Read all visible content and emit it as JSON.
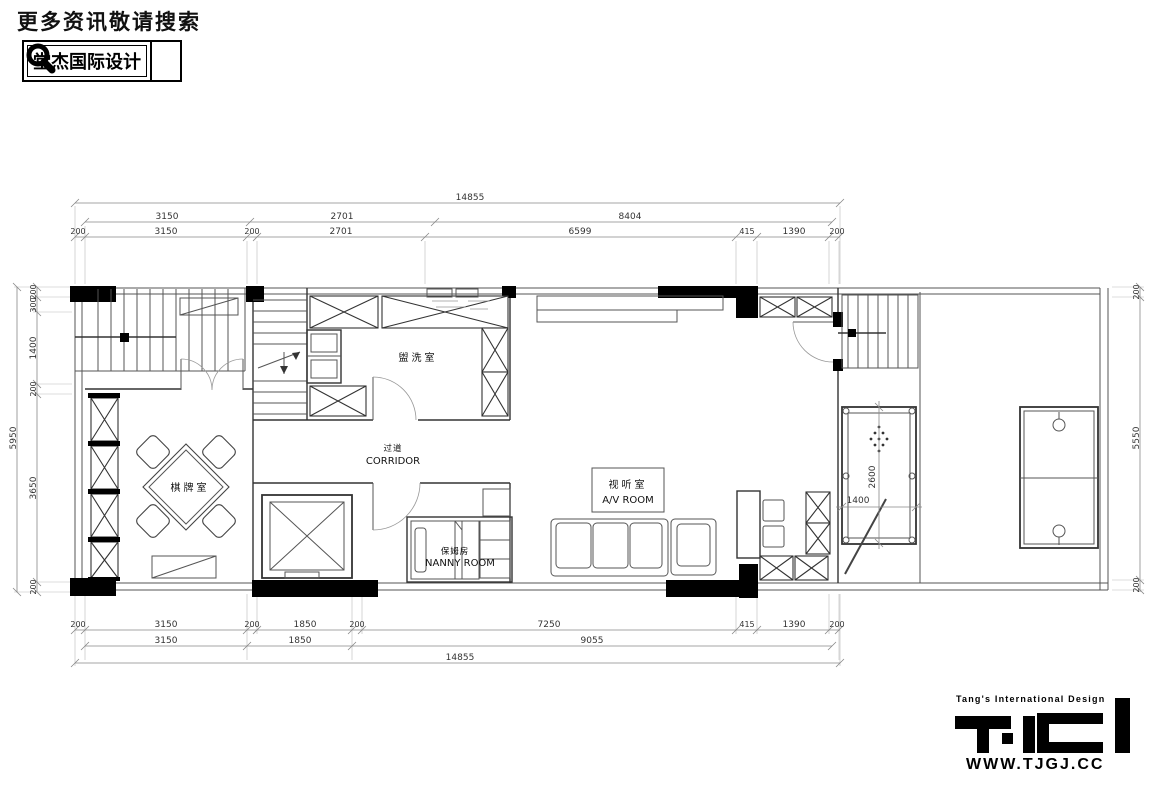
{
  "header": {
    "search_prompt": "更多资讯敬请搜索",
    "brand_name": "堂杰国际设计"
  },
  "branding": {
    "tagline": "Tang's International Design",
    "website": "WWW.TJGJ.CC"
  },
  "plan": {
    "labels": {
      "mahjong_room": "棋牌室",
      "laundry_room": "盥洗室",
      "corridor_cn": "过道",
      "corridor_en": "CORRIDOR",
      "nanny_cn": "保姆房",
      "nanny_en": "NANNY ROOM",
      "av_cn": "视听室",
      "av_en": "A/V ROOM"
    },
    "dimensions": {
      "top": {
        "total": "14855",
        "row2": [
          "3150",
          "2701",
          "8404"
        ],
        "row3": [
          "200",
          "3150",
          "200",
          "2701",
          "6599",
          "415",
          "1390",
          "200"
        ]
      },
      "bottom": {
        "row1": [
          "200",
          "3150",
          "200",
          "1850",
          "200",
          "7250",
          "415",
          "1390",
          "200"
        ],
        "row2": [
          "3150",
          "1850",
          "9055"
        ],
        "total": "14855"
      },
      "left": {
        "total": "5950",
        "segments": [
          "200",
          "300",
          "1400",
          "200",
          "3650",
          "200"
        ]
      },
      "right": {
        "segments": [
          "200",
          "5550",
          "200"
        ]
      },
      "pool_table": {
        "length": "2600",
        "width": "1400"
      }
    }
  }
}
